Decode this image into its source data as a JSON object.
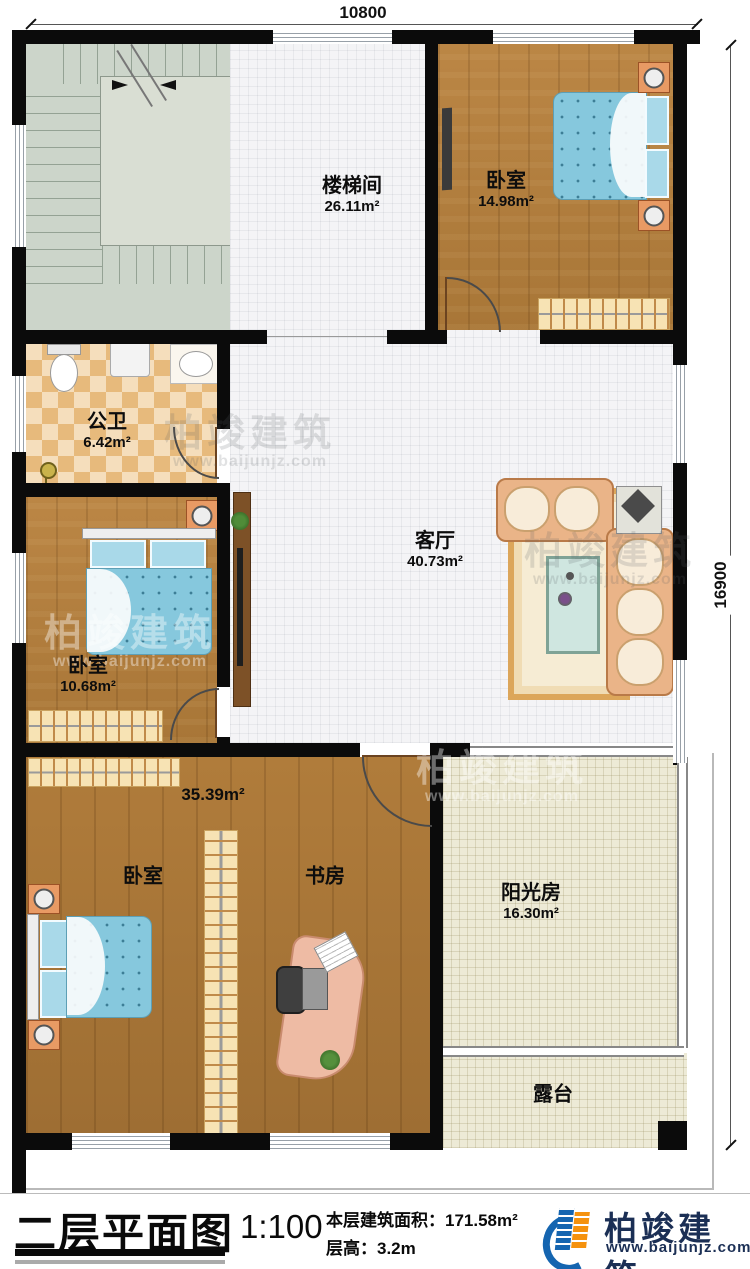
{
  "plan": {
    "dim_width": "10800",
    "dim_height": "16900"
  },
  "rooms": {
    "stairwell": {
      "name": "楼梯间",
      "area": "26.11m²"
    },
    "bedroom1": {
      "name": "卧室",
      "area": "14.98m²"
    },
    "bathroom": {
      "name": "公卫",
      "area": "6.42m²"
    },
    "living": {
      "name": "客厅",
      "area": "40.73m²"
    },
    "bedroom2": {
      "name": "卧室",
      "area": "10.68m²"
    },
    "suite": {
      "area": "35.39m²"
    },
    "bedroom3": {
      "name": "卧室"
    },
    "study": {
      "name": "书房"
    },
    "sunroom": {
      "name": "阳光房",
      "area": "16.30m²"
    },
    "terrace": {
      "name": "露台"
    }
  },
  "title_block": {
    "title": "二层平面图",
    "scale": "1:100",
    "area_label": "本层建筑面积：",
    "area_value": "171.58m²",
    "height_label": "层高：",
    "height_value": "3.2m",
    "brand": "柏竣建筑",
    "website": "www.baijunjz.com"
  },
  "watermark": {
    "brand": "柏竣建筑",
    "website": "www.baijunjz.com"
  },
  "colors": {
    "wall": "#0b0b0b",
    "brand_navy": "#1b2f55",
    "logo_blue": "#1565b0",
    "logo_orange": "#f5920e"
  }
}
